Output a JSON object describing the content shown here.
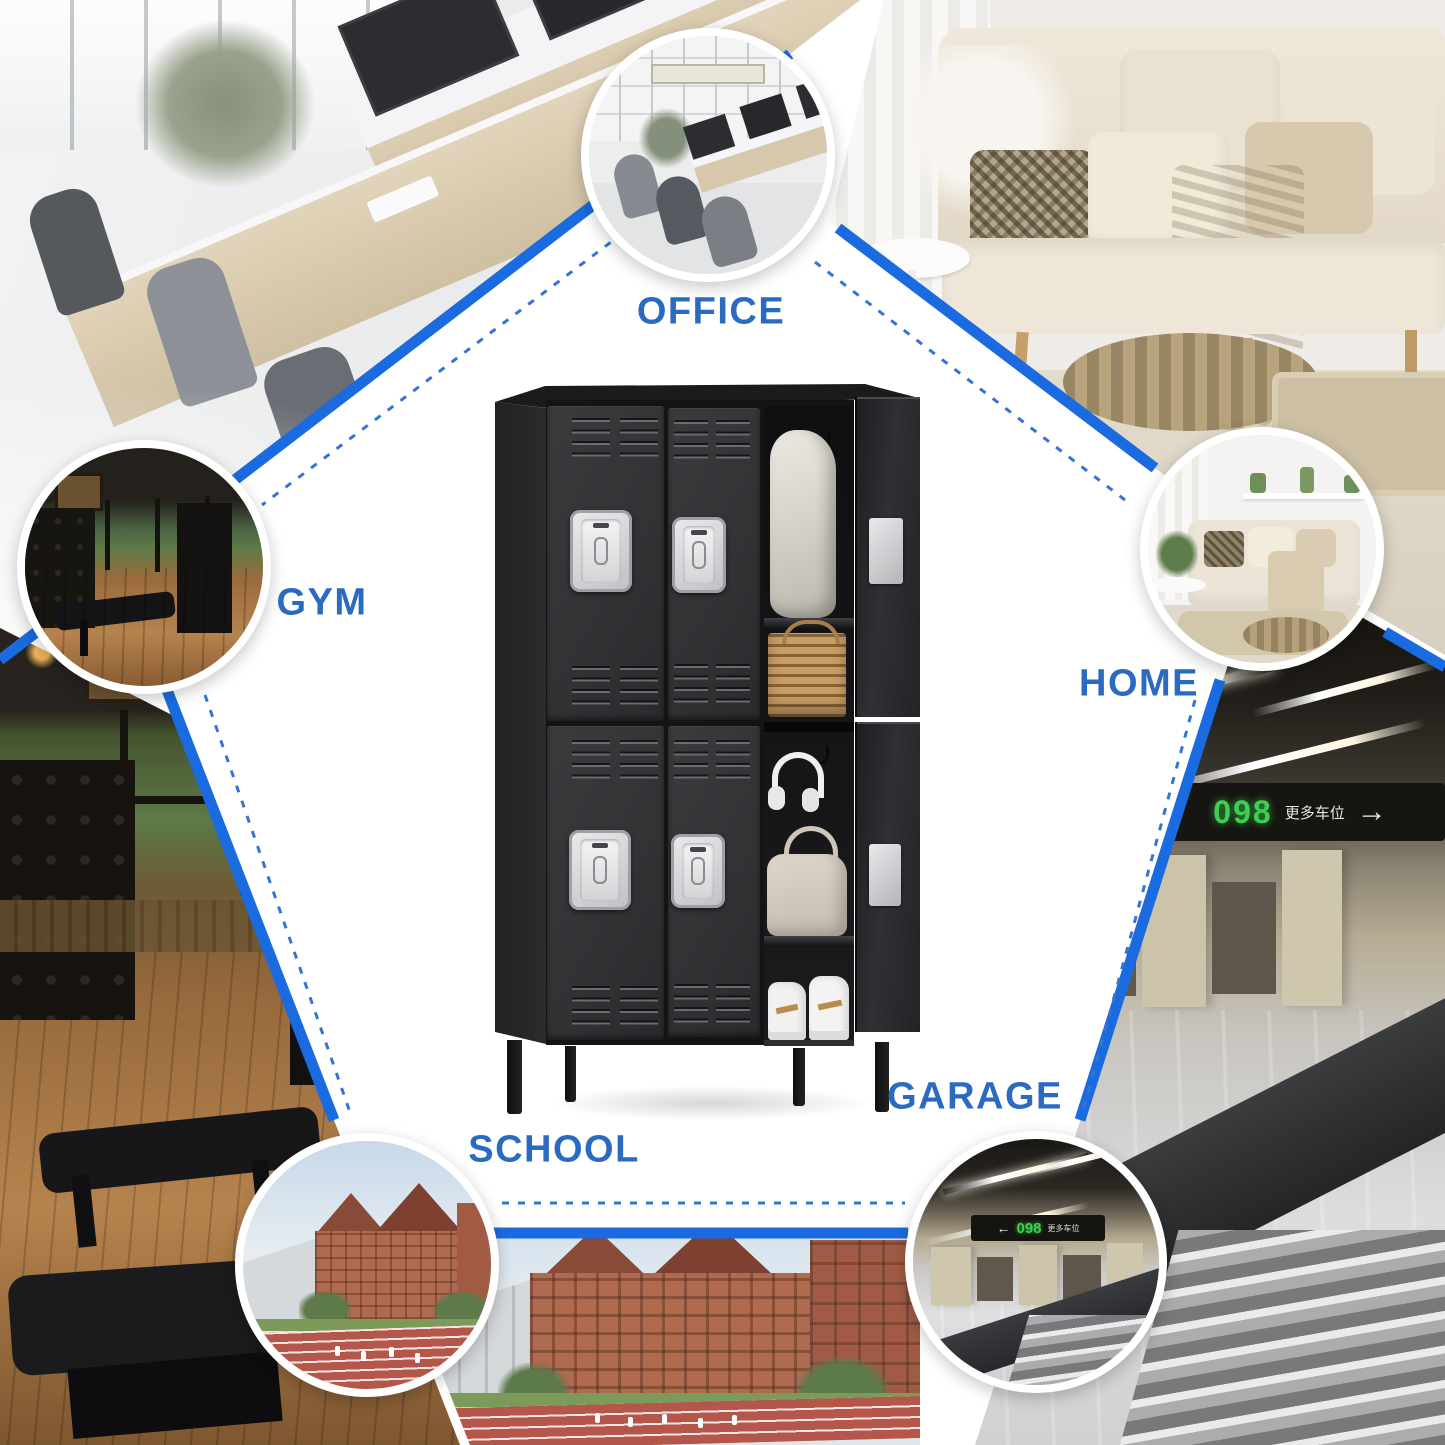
{
  "poster": {
    "labels": {
      "office": "OFFICE",
      "gym": "GYM",
      "home": "HOME",
      "school": "SCHOOL",
      "garage": "GARAGE"
    },
    "garage_sign": {
      "number": "098",
      "caption": "更多车位",
      "arrow": "→",
      "arrow_left": "←"
    },
    "colors": {
      "solid_line_blue": "#1b6be0",
      "dashed_line_blue": "#3474d4",
      "label_blue": "#2a6ac0",
      "circle_border_white": "#ffffff",
      "locker_black": "#313134",
      "handle_silver": "#d7d8da",
      "sign_green": "#3ecf52"
    },
    "locker_layout": {
      "columns": 3,
      "rows": 2,
      "doors_closed": 4,
      "doors_open": 2
    },
    "locker_contents": [
      "hanging-coat",
      "storage-basket",
      "headphones",
      "handbag",
      "sneakers"
    ]
  }
}
